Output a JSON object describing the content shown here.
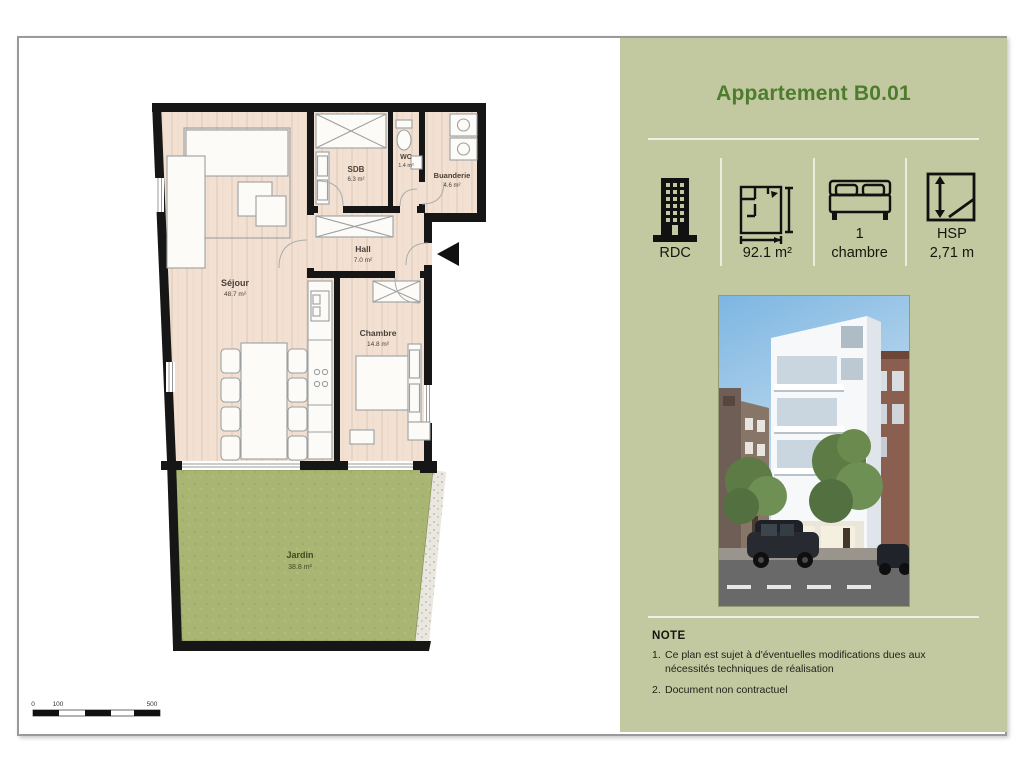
{
  "panel": {
    "title": "Appartement B0.01",
    "specs": [
      {
        "name": "floor",
        "icon": "building-icon",
        "line1": "",
        "line2": "RDC"
      },
      {
        "name": "surface",
        "icon": "floorplan-icon",
        "line1": "",
        "line2": "92.1 m²"
      },
      {
        "name": "bedrooms",
        "icon": "bed-icon",
        "line1": "1",
        "line2": "chambre"
      },
      {
        "name": "ceiling-height",
        "icon": "height-icon",
        "line1": "HSP",
        "line2": "2,71 m"
      }
    ],
    "note": {
      "heading": "NOTE",
      "items": [
        {
          "num": "1.",
          "text": "Ce plan est sujet à d'éventuelles modifications dues aux nécessités techniques de réalisation"
        },
        {
          "num": "2.",
          "text": "Document non contractuel"
        }
      ]
    }
  },
  "plan": {
    "rooms": [
      {
        "name": "Séjour",
        "area": "48.7 m²"
      },
      {
        "name": "Chambre",
        "area": "14.8 m²"
      },
      {
        "name": "SDB",
        "area": "6.3 m²"
      },
      {
        "name": "WC",
        "area": "1.4 m²"
      },
      {
        "name": "Buanderie",
        "area": "4.6 m²"
      },
      {
        "name": "Hall",
        "area": "7.0 m²"
      },
      {
        "name": "Jardin",
        "area": "38.8 m²"
      }
    ],
    "scale": {
      "labels": [
        "0",
        "100",
        "500"
      ]
    }
  },
  "colors": {
    "panel_bg": "#c2c8a0",
    "title_green": "#4d7c2f",
    "wall_black": "#161616",
    "floor_tan": "#f2e1d3",
    "garden_green": "#a9b573",
    "frame_grey": "#9a9a9a"
  }
}
